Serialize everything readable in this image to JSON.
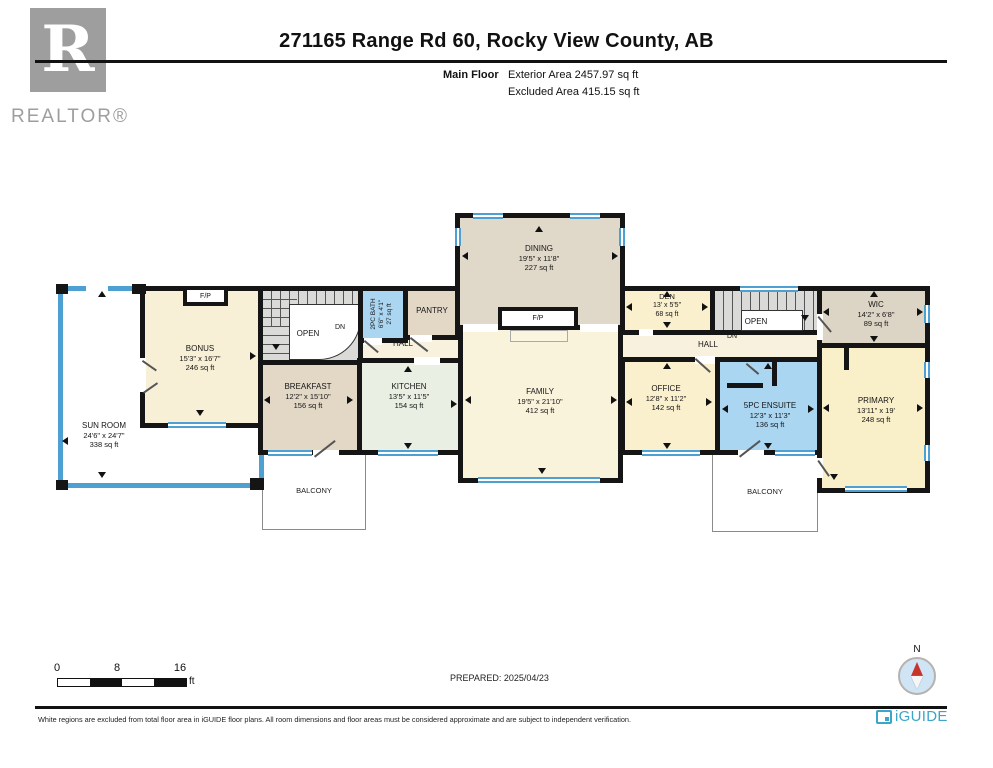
{
  "header": {
    "title": "271165 Range Rd 60, Rocky View County, AB",
    "floor_label": "Main Floor",
    "exterior_area": "Exterior Area 2457.97 sq ft",
    "excluded_area": "Excluded Area 415.15 sq ft",
    "realtor_r": "R",
    "realtor_wordmark": "REALTOR®"
  },
  "rooms": [
    {
      "name": "SUN ROOM",
      "dims": "24'6\" x 24'7\"",
      "area": "338 sq ft"
    },
    {
      "name": "BONUS",
      "dims": "15'3\" x 16'7\"",
      "area": "246 sq ft"
    },
    {
      "name": "BREAKFAST",
      "dims": "12'2\" x 15'10\"",
      "area": "156 sq ft"
    },
    {
      "name": "KITCHEN",
      "dims": "13'5\" x 11'5\"",
      "area": "154 sq ft"
    },
    {
      "name": "DINING",
      "dims": "19'5\" x 11'8\"",
      "area": "227 sq ft"
    },
    {
      "name": "FAMILY",
      "dims": "19'5\" x 21'10\"",
      "area": "412 sq ft"
    },
    {
      "name": "2PC BATH",
      "dims": "6'6\" x 4'1\"",
      "area": "27 sq ft"
    },
    {
      "name": "PANTRY"
    },
    {
      "name": "DEN",
      "dims": "13' x 5'5\"",
      "area": "68 sq ft"
    },
    {
      "name": "OFFICE",
      "dims": "12'8\" x 11'2\"",
      "area": "142 sq ft"
    },
    {
      "name": "5PC ENSUITE",
      "dims": "12'3\" x 11'3\"",
      "area": "136 sq ft"
    },
    {
      "name": "WIC",
      "dims": "14'2\" x 6'8\"",
      "area": "89 sq ft"
    },
    {
      "name": "PRIMARY",
      "dims": "13'11\" x 19'",
      "area": "248 sq ft"
    }
  ],
  "labels": {
    "open": "OPEN",
    "dn": "DN",
    "fp": "F/P",
    "hall": "HALL",
    "balcony": "BALCONY"
  },
  "scale_bar": {
    "ticks": [
      "0",
      "8",
      "16"
    ],
    "unit": "ft"
  },
  "footer": {
    "prepared": "PREPARED: 2025/04/23",
    "compass_label": "N",
    "disclaimer": "White regions are excluded from total floor area in iGUIDE floor plans. All room dimensions and floor areas must be considered approximate and are subject to independent verification.",
    "brand": "iGUIDE"
  },
  "colors": {
    "wall": "#151515",
    "window_blue": "#4E9FD2",
    "bath_blue": "#ABD6F1",
    "cream": "#FAF3DC",
    "cream_yellow": "#FAF0CE",
    "tan": "#E3D8C6",
    "dining_tan": "#E0D8C9",
    "kitchen_green": "#E9EFE2",
    "wic_gray": "#DCD4C4",
    "stair_gray": "#DADAD8",
    "hall_cream": "#F8F1DE",
    "brand_teal": "#3BA6C8",
    "compass_red": "#C8342C",
    "logo_gray": "#9e9e9e"
  }
}
